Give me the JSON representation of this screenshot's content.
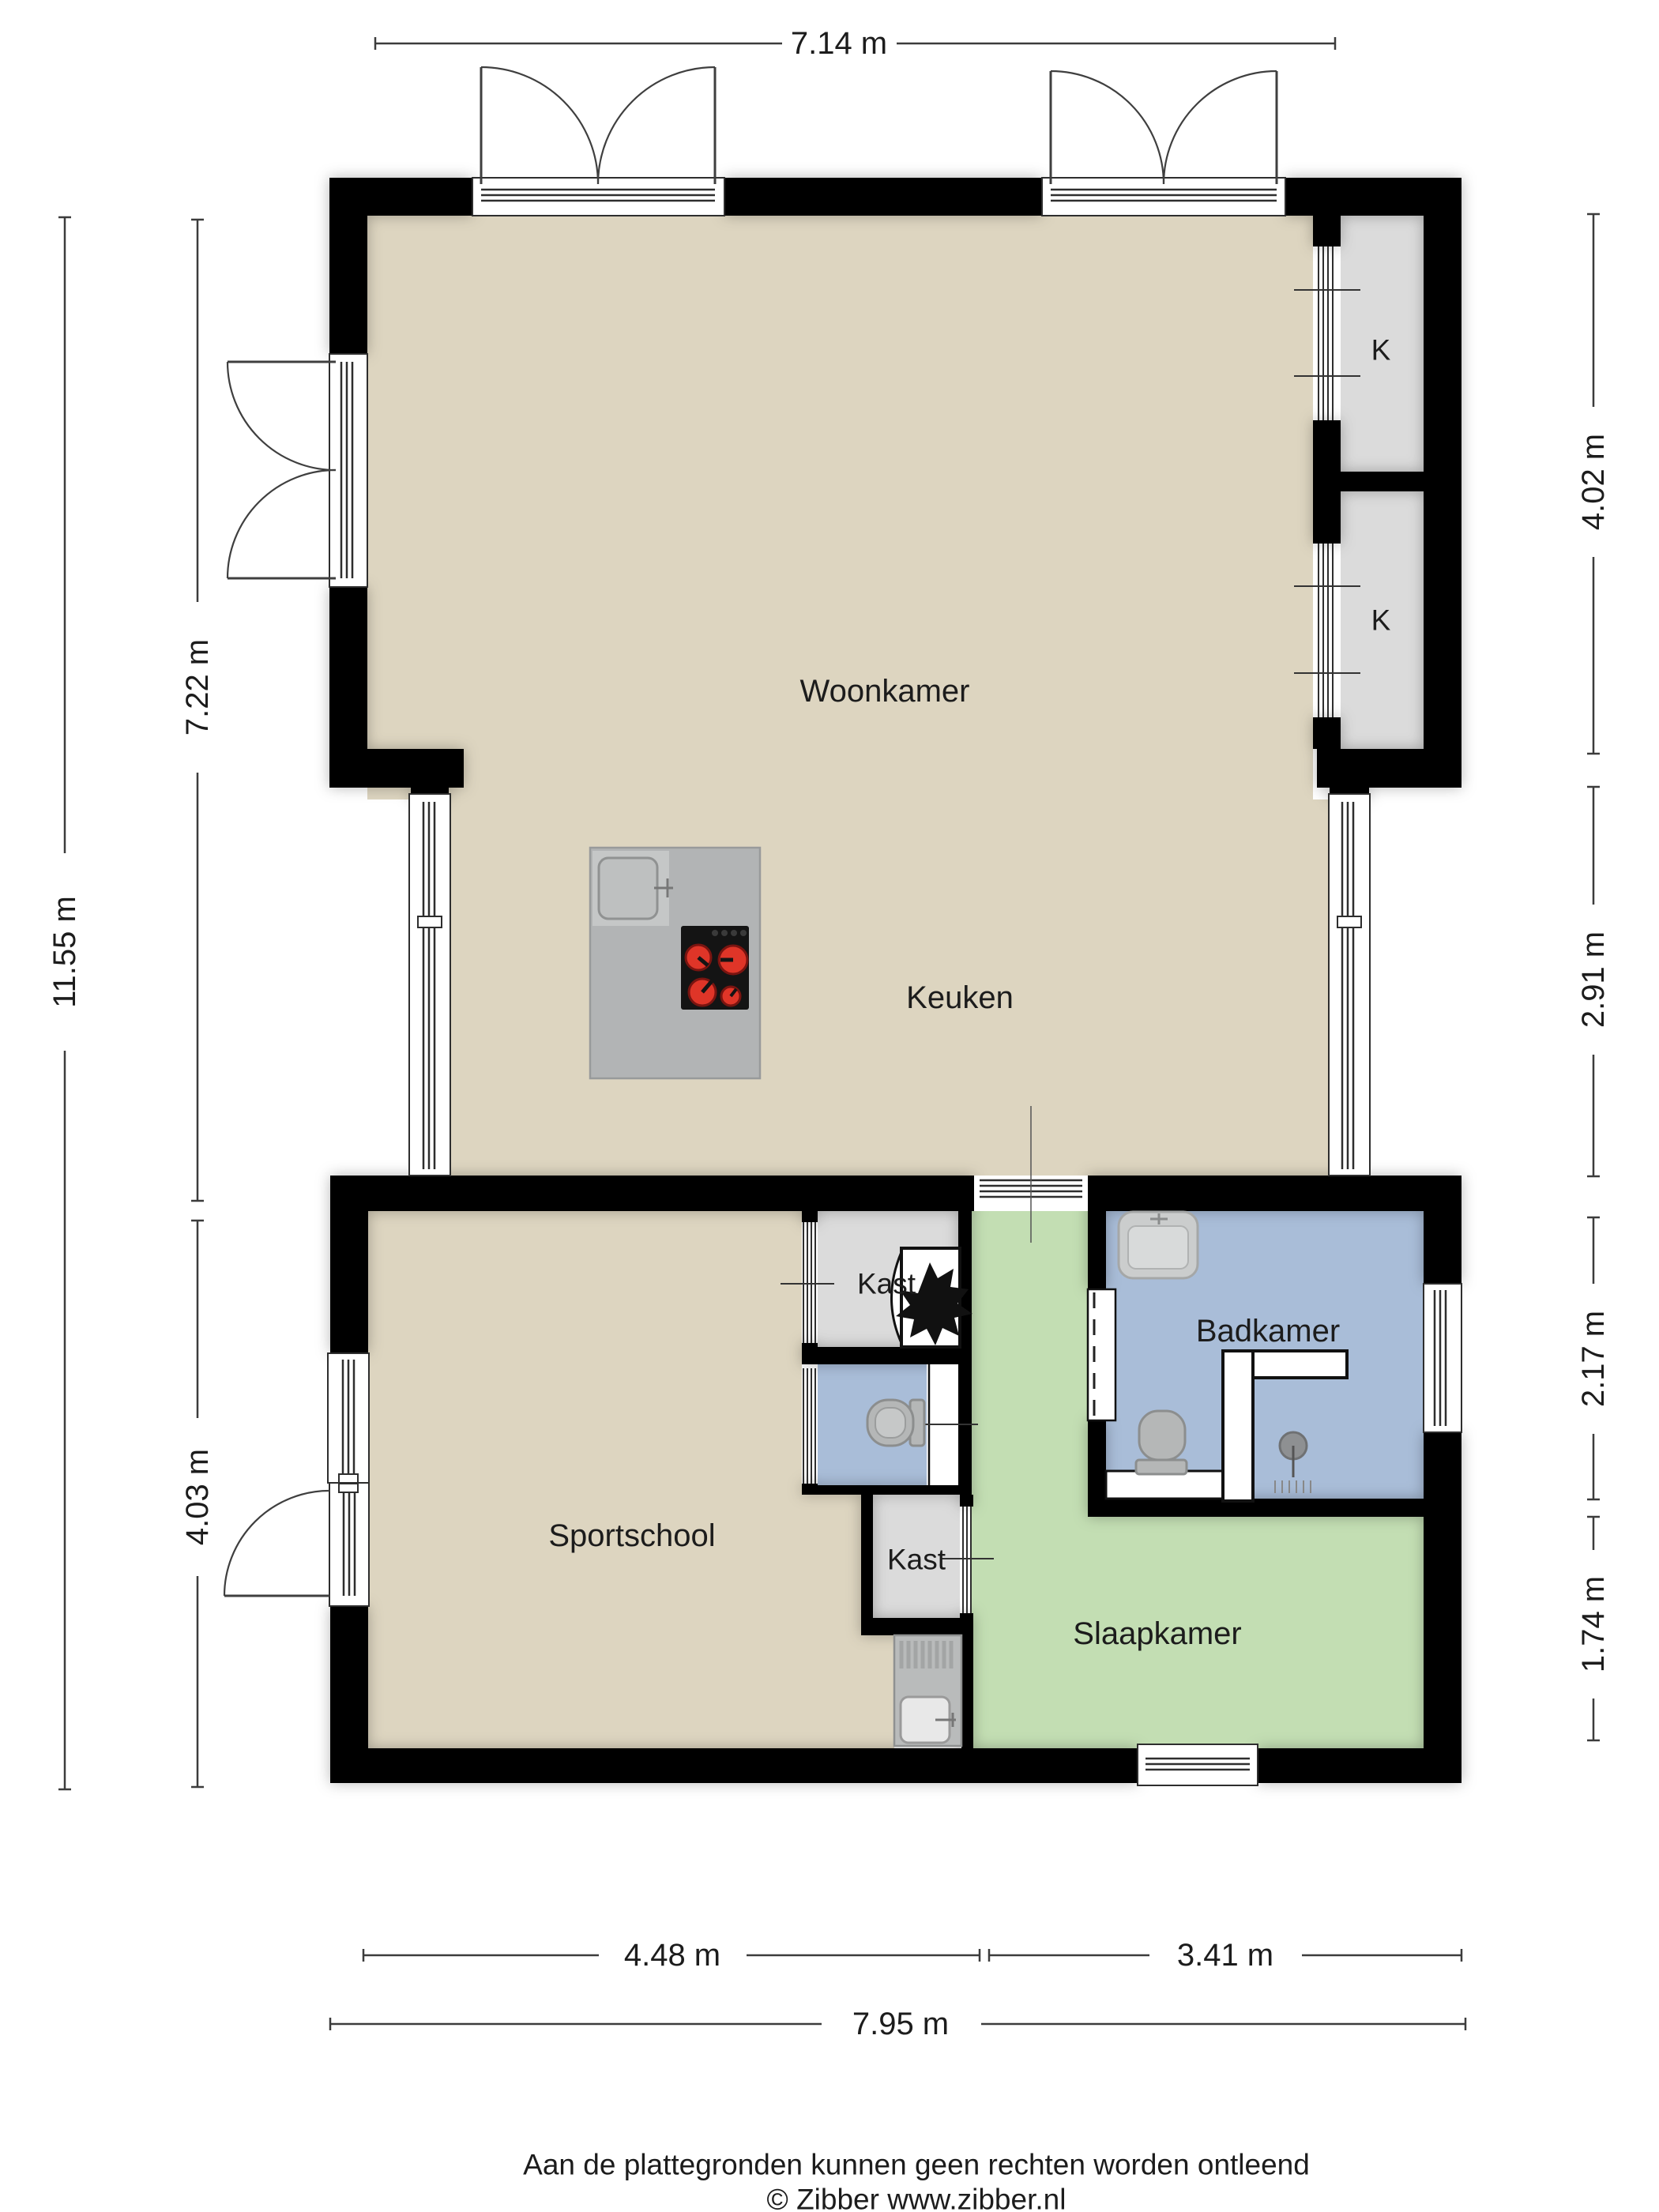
{
  "rooms": {
    "woonkamer": "Woonkamer",
    "keuken": "Keuken",
    "sportschool": "Sportschool",
    "badkamer": "Badkamer",
    "slaapkamer": "Slaapkamer",
    "kast_upper": "Kast",
    "kast_lower": "Kast",
    "closet_k1": "K",
    "closet_k2": "K"
  },
  "dimensions": {
    "top": "7.14 m",
    "left_total": "11.55 m",
    "left_upper": "7.22 m",
    "left_lower": "4.03 m",
    "right_upper": "4.02 m",
    "right_mid": "2.91 m",
    "right_bath": "2.17 m",
    "right_bottom": "1.74 m",
    "bottom_left": "4.48 m",
    "bottom_right": "3.41 m",
    "bottom_total": "7.95 m"
  },
  "footer": {
    "disclaimer": "Aan de plattegronden kunnen geen rechten worden ontleend",
    "copyright": "© Zibber www.zibber.nl"
  },
  "colors": {
    "floor": "#ddd5c0",
    "closet": "#dbdbdb",
    "bath": "#a9bdd8",
    "bed": "#c3deb3",
    "wall": "#000000",
    "ink": "#1c1c1c",
    "dim": "#3c3c3c",
    "island": "#b2b4b5",
    "cooktop": "#141414",
    "burner": "#df3528"
  }
}
